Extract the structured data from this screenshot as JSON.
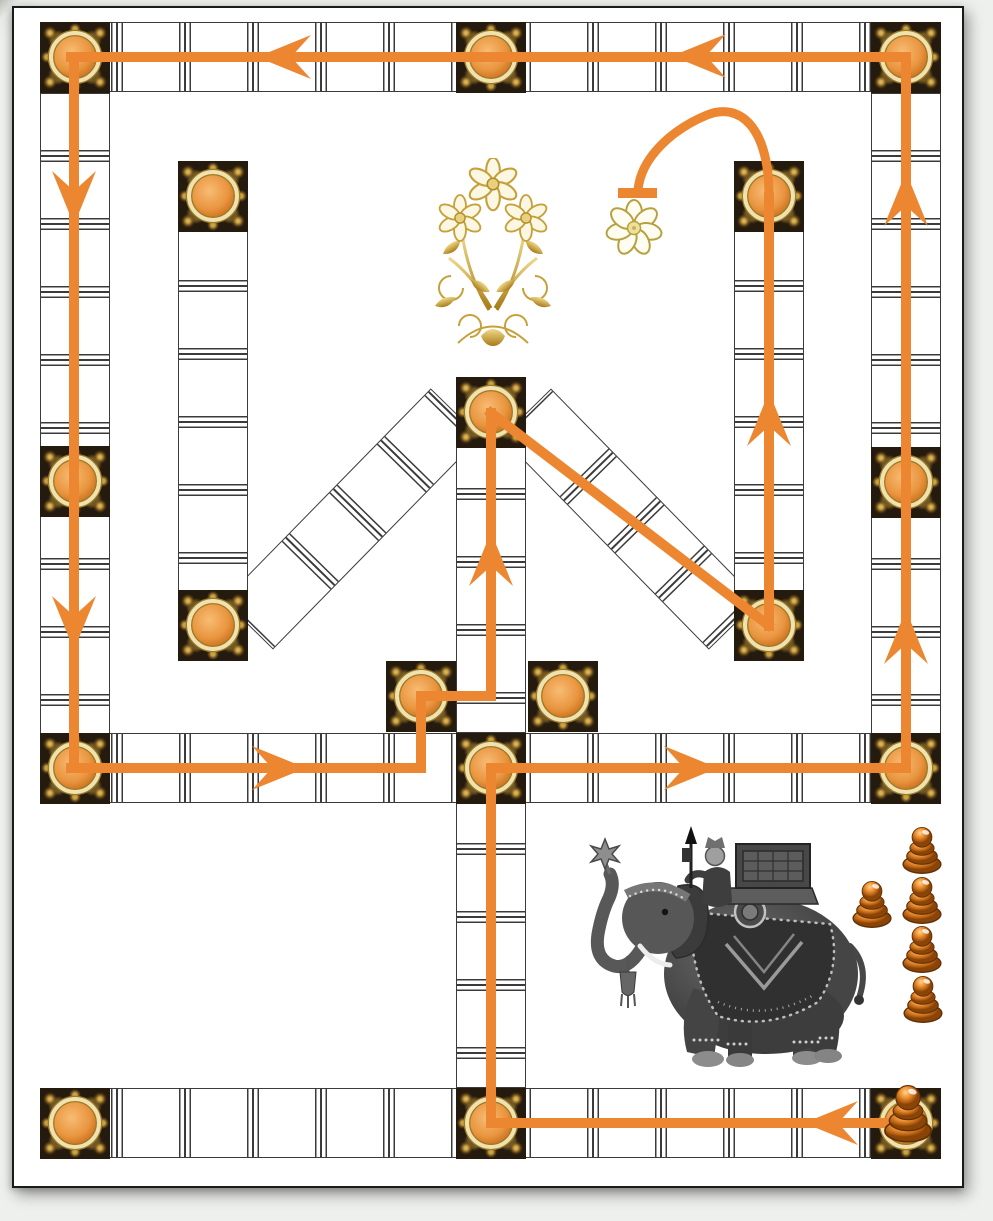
{
  "board": {
    "name": "elephant-race-board",
    "palette": {
      "path_orange": "#EC8630",
      "tile_black": "#241A0E",
      "gold": "#C9A23C",
      "ivory_ring": "#EFE2B0",
      "orb_light": "#F8BC74",
      "orb_dark": "#A85812",
      "track_line": "#3B3B3B",
      "pawn_orange": "#EE9233",
      "board_white": "#FFFFFF"
    },
    "waypoints": [
      {
        "id": "top-left-corner",
        "x": 40,
        "y": 22
      },
      {
        "id": "top-center",
        "x": 456,
        "y": 22
      },
      {
        "id": "top-right-corner",
        "x": 871,
        "y": 22
      },
      {
        "id": "left-middle",
        "x": 40,
        "y": 446
      },
      {
        "id": "left-middle-row",
        "x": 40,
        "y": 733
      },
      {
        "id": "right-middle",
        "x": 871,
        "y": 447
      },
      {
        "id": "right-middle-row",
        "x": 871,
        "y": 733
      },
      {
        "id": "middle-row-center",
        "x": 456,
        "y": 733
      },
      {
        "id": "bottom-left-corner",
        "x": 40,
        "y": 1088
      },
      {
        "id": "bottom-center",
        "x": 456,
        "y": 1088
      },
      {
        "id": "bottom-right-corner-start",
        "x": 871,
        "y": 1088
      },
      {
        "id": "inner-left-top",
        "x": 178,
        "y": 161
      },
      {
        "id": "inner-left-bottom",
        "x": 178,
        "y": 590
      },
      {
        "id": "inner-right-top",
        "x": 734,
        "y": 161
      },
      {
        "id": "inner-right-bottom",
        "x": 734,
        "y": 590
      },
      {
        "id": "center-peak",
        "x": 456,
        "y": 377
      },
      {
        "id": "small-left",
        "x": 386,
        "y": 661
      },
      {
        "id": "small-right",
        "x": 528,
        "y": 661
      }
    ],
    "path": {
      "finish_marker": "goal-flower",
      "arrows": [
        {
          "dir": "left",
          "x": 285,
          "y": 57
        },
        {
          "dir": "left",
          "x": 700,
          "y": 56
        },
        {
          "dir": "down",
          "x": 74,
          "y": 197
        },
        {
          "dir": "down",
          "x": 74,
          "y": 622
        },
        {
          "dir": "right",
          "x": 278,
          "y": 768
        },
        {
          "dir": "right",
          "x": 690,
          "y": 768
        },
        {
          "dir": "up",
          "x": 906,
          "y": 200
        },
        {
          "dir": "up",
          "x": 906,
          "y": 638
        },
        {
          "dir": "up",
          "x": 769,
          "y": 420
        },
        {
          "dir": "up",
          "x": 491,
          "y": 560
        },
        {
          "dir": "left",
          "x": 832,
          "y": 1123
        }
      ]
    },
    "pawns": {
      "count": 6,
      "color": "#EE9233",
      "positions": [
        {
          "x": 922,
          "y": 851,
          "size": 54,
          "on_board": false
        },
        {
          "x": 872,
          "y": 905,
          "size": 54,
          "on_board": false
        },
        {
          "x": 922,
          "y": 901,
          "size": 54,
          "on_board": false
        },
        {
          "x": 922,
          "y": 950,
          "size": 54,
          "on_board": false
        },
        {
          "x": 923,
          "y": 1000,
          "size": 54,
          "on_board": false
        },
        {
          "x": 908,
          "y": 1114,
          "size": 66,
          "on_board": true
        }
      ]
    },
    "decorations": [
      {
        "id": "golden-bouquet",
        "x": 413,
        "y": 158
      },
      {
        "id": "goal-flower",
        "x": 605,
        "y": 198
      },
      {
        "id": "war-elephant",
        "x": 578,
        "y": 826
      }
    ]
  }
}
